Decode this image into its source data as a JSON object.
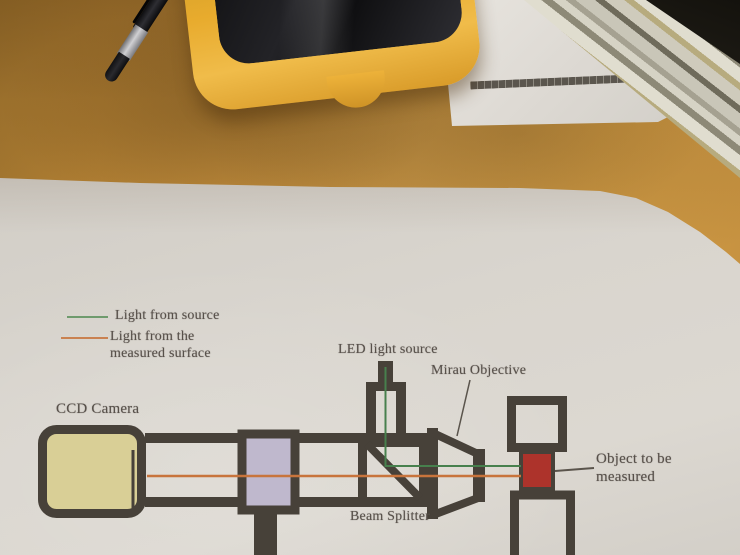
{
  "colors": {
    "ink": "#474139",
    "text": "#57504a",
    "green": "#47804d",
    "green-legend": "#6f9b6d",
    "orange": "#c8743c",
    "yellow-box": "#d9cf96",
    "purple-box": "#bfb8cd",
    "red-box": "#ad332b",
    "paper": "#d5d1ca",
    "desk": "#d29a43",
    "device-yellow": "#e8ab2d",
    "device-black": "#1a191b",
    "pen-silver": "#c0c0c3"
  },
  "diagram": {
    "legend": {
      "items": [
        {
          "label": "Light from source",
          "line_color": "#6f9b6d"
        },
        {
          "label": "Light from the\nmeasured surface",
          "line_color": "#c8743c"
        }
      ]
    },
    "labels": {
      "ccd_camera": "CCD Camera",
      "led_light_source": "LED light source",
      "mirau_objective": "Mirau Objective",
      "beam_splitter": "Beam Splitter",
      "object_to_be_measured": "Object to be\nmeasured"
    }
  }
}
